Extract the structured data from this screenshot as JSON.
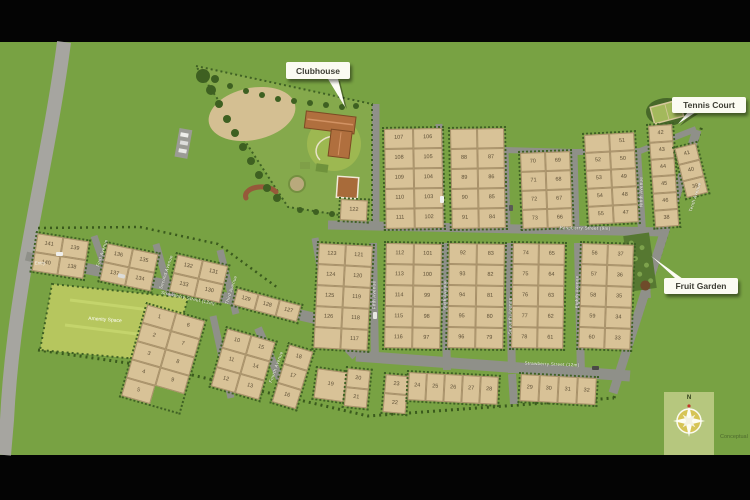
{
  "callouts": {
    "clubhouse": "Clubhouse",
    "tennis_court": "Tennis Court",
    "fruit_garden": "Fruit Garden"
  },
  "areas": {
    "amenity_space": "Amenity Space",
    "entry": "Entry"
  },
  "compass": {
    "north_label": "N"
  },
  "watermark": "Conceptual",
  "street_labels": [
    {
      "name": "Raspberry Street (9m)",
      "x": 585,
      "y": 228,
      "rot": 1
    },
    {
      "name": "Strawberry Street (12m)",
      "x": 188,
      "y": 298,
      "rot": 12
    },
    {
      "name": "Strawberry Street (12m)",
      "x": 552,
      "y": 364,
      "rot": 2
    },
    {
      "name": "First Avenue",
      "x": 102,
      "y": 253,
      "rot": -72
    },
    {
      "name": "Second Avenue",
      "x": 166,
      "y": 272,
      "rot": -72
    },
    {
      "name": "Third Avenue",
      "x": 231,
      "y": 290,
      "rot": -72
    },
    {
      "name": "Fourth Avenue",
      "x": 276,
      "y": 367,
      "rot": -70
    },
    {
      "name": "Fifth Avenue",
      "x": 374,
      "y": 295,
      "rot": -90
    },
    {
      "name": "Sixth Avenue",
      "x": 445,
      "y": 295,
      "rot": -90
    },
    {
      "name": "Seventh Avenue",
      "x": 510,
      "y": 316,
      "rot": -90
    },
    {
      "name": "Eighth Avenue",
      "x": 577,
      "y": 292,
      "rot": -90
    },
    {
      "name": "Ninth Avenue",
      "x": 641,
      "y": 192,
      "rot": -90
    },
    {
      "name": "Tenth Avenue",
      "x": 695,
      "y": 197,
      "rot": -72
    }
  ],
  "blocks": [
    {
      "x": 382,
      "y": 127,
      "cw": 29,
      "ch": 20,
      "rot": -1,
      "cols": [
        [
          "107",
          "108",
          "109",
          "110",
          "111"
        ],
        [
          "106",
          "105",
          "104",
          "103",
          "102"
        ]
      ]
    },
    {
      "x": 448,
      "y": 127,
      "cw": 27,
      "ch": 20,
      "rot": -1,
      "cols": [
        [
          "",
          "88",
          "89",
          "90",
          "91"
        ],
        [
          "",
          "87",
          "86",
          "85",
          "84"
        ]
      ]
    },
    {
      "x": 518,
      "y": 151,
      "cw": 25,
      "ch": 19,
      "rot": -2,
      "cols": [
        [
          "70",
          "71",
          "72",
          "73"
        ],
        [
          "69",
          "68",
          "67",
          "66"
        ]
      ]
    },
    {
      "x": 582,
      "y": 133,
      "cw": 25,
      "ch": 18,
      "rot": -3,
      "cols": [
        [
          "",
          "52",
          "53",
          "54",
          "55"
        ],
        [
          "51",
          "50",
          "49",
          "48",
          "47"
        ]
      ]
    },
    {
      "x": 646,
      "y": 124,
      "cw": 24,
      "ch": 17,
      "rot": -4,
      "cols": [
        [
          "42",
          "43",
          "44",
          "45",
          "46",
          "38"
        ]
      ]
    },
    {
      "x": 672,
      "y": 147,
      "cw": 22,
      "ch": 17,
      "rot": -14,
      "cols": [
        [
          "41",
          "40",
          "39"
        ]
      ]
    },
    {
      "x": 36,
      "y": 231,
      "cw": 26,
      "ch": 19,
      "rot": 9,
      "cols": [
        [
          "141",
          "140"
        ],
        [
          "139",
          "138"
        ]
      ]
    },
    {
      "x": 106,
      "y": 241,
      "cw": 26,
      "ch": 19,
      "rot": 12,
      "cols": [
        [
          "136",
          "137"
        ],
        [
          "135",
          "134"
        ]
      ]
    },
    {
      "x": 176,
      "y": 252,
      "cw": 26,
      "ch": 19,
      "rot": 13,
      "cols": [
        [
          "132",
          "133"
        ],
        [
          "131",
          "130"
        ]
      ]
    },
    {
      "x": 236,
      "y": 286,
      "cw": 22,
      "ch": 17,
      "rot": 15,
      "cols": [
        [
          "129"
        ],
        [
          "128"
        ],
        [
          "127"
        ]
      ]
    },
    {
      "x": 317,
      "y": 241,
      "cw": 27,
      "ch": 21,
      "rot": 3,
      "cols": [
        [
          "123",
          "124",
          "125",
          "126",
          ""
        ],
        [
          "121",
          "120",
          "119",
          "118",
          "117"
        ]
      ]
    },
    {
      "x": 384,
      "y": 241,
      "cw": 28,
      "ch": 21,
      "rot": 1,
      "cols": [
        [
          "112",
          "113",
          "114",
          "115",
          "116"
        ],
        [
          "101",
          "100",
          "99",
          "98",
          "97"
        ]
      ]
    },
    {
      "x": 447,
      "y": 241,
      "cw": 28,
      "ch": 21,
      "rot": 1,
      "cols": [
        [
          "92",
          "93",
          "94",
          "95",
          "96"
        ],
        [
          "83",
          "82",
          "81",
          "80",
          "79"
        ]
      ]
    },
    {
      "x": 511,
      "y": 241,
      "cw": 26,
      "ch": 21,
      "rot": 1,
      "cols": [
        [
          "74",
          "75",
          "76",
          "77",
          "78"
        ],
        [
          "65",
          "64",
          "63",
          "62",
          "61"
        ]
      ]
    },
    {
      "x": 580,
      "y": 241,
      "cw": 26,
      "ch": 21,
      "rot": 2,
      "cols": [
        [
          "56",
          "57",
          "58",
          "59",
          "60"
        ],
        [
          "37",
          "36",
          "35",
          "34",
          "33"
        ]
      ]
    },
    {
      "x": 339,
      "y": 197,
      "cw": 27,
      "ch": 21,
      "rot": 3,
      "cols": [
        [
          "122"
        ]
      ]
    },
    {
      "x": 146,
      "y": 302,
      "cw": 30,
      "ch": 19,
      "rot": 16,
      "cols": [
        [
          "1",
          "2",
          "3",
          "4",
          "5"
        ],
        [
          "6",
          "7",
          "8",
          "9",
          null
        ]
      ]
    },
    {
      "x": 226,
      "y": 326,
      "cw": 25,
      "ch": 20,
      "rot": 16,
      "cols": [
        [
          "10",
          "11",
          "12"
        ],
        [
          "15",
          "14",
          "13"
        ]
      ]
    },
    {
      "x": 288,
      "y": 342,
      "cw": 25,
      "ch": 20,
      "rot": 17,
      "cols": [
        [
          "18",
          "17",
          "16"
        ]
      ]
    },
    {
      "x": 316,
      "y": 366,
      "cw": 30,
      "ch": 30,
      "rot": 8,
      "cols": [
        [
          "19"
        ]
      ]
    },
    {
      "x": 346,
      "y": 366,
      "cw": 23,
      "ch": 19,
      "rot": 6,
      "cols": [
        [
          "20",
          "21"
        ]
      ]
    },
    {
      "x": 384,
      "y": 372,
      "cw": 23,
      "ch": 19,
      "rot": 5,
      "cols": [
        [
          "23",
          "22"
        ]
      ]
    },
    {
      "x": 407,
      "y": 370,
      "cw": 18,
      "ch": 28,
      "rot": 3,
      "cols": [
        [
          "24"
        ],
        [
          "25"
        ],
        [
          "26"
        ],
        [
          "27"
        ],
        [
          "28"
        ]
      ]
    },
    {
      "x": 519,
      "y": 372,
      "cw": 19,
      "ch": 27,
      "rot": 3,
      "cols": [
        [
          "29"
        ],
        [
          "30"
        ],
        [
          "31"
        ],
        [
          "32"
        ]
      ]
    }
  ]
}
